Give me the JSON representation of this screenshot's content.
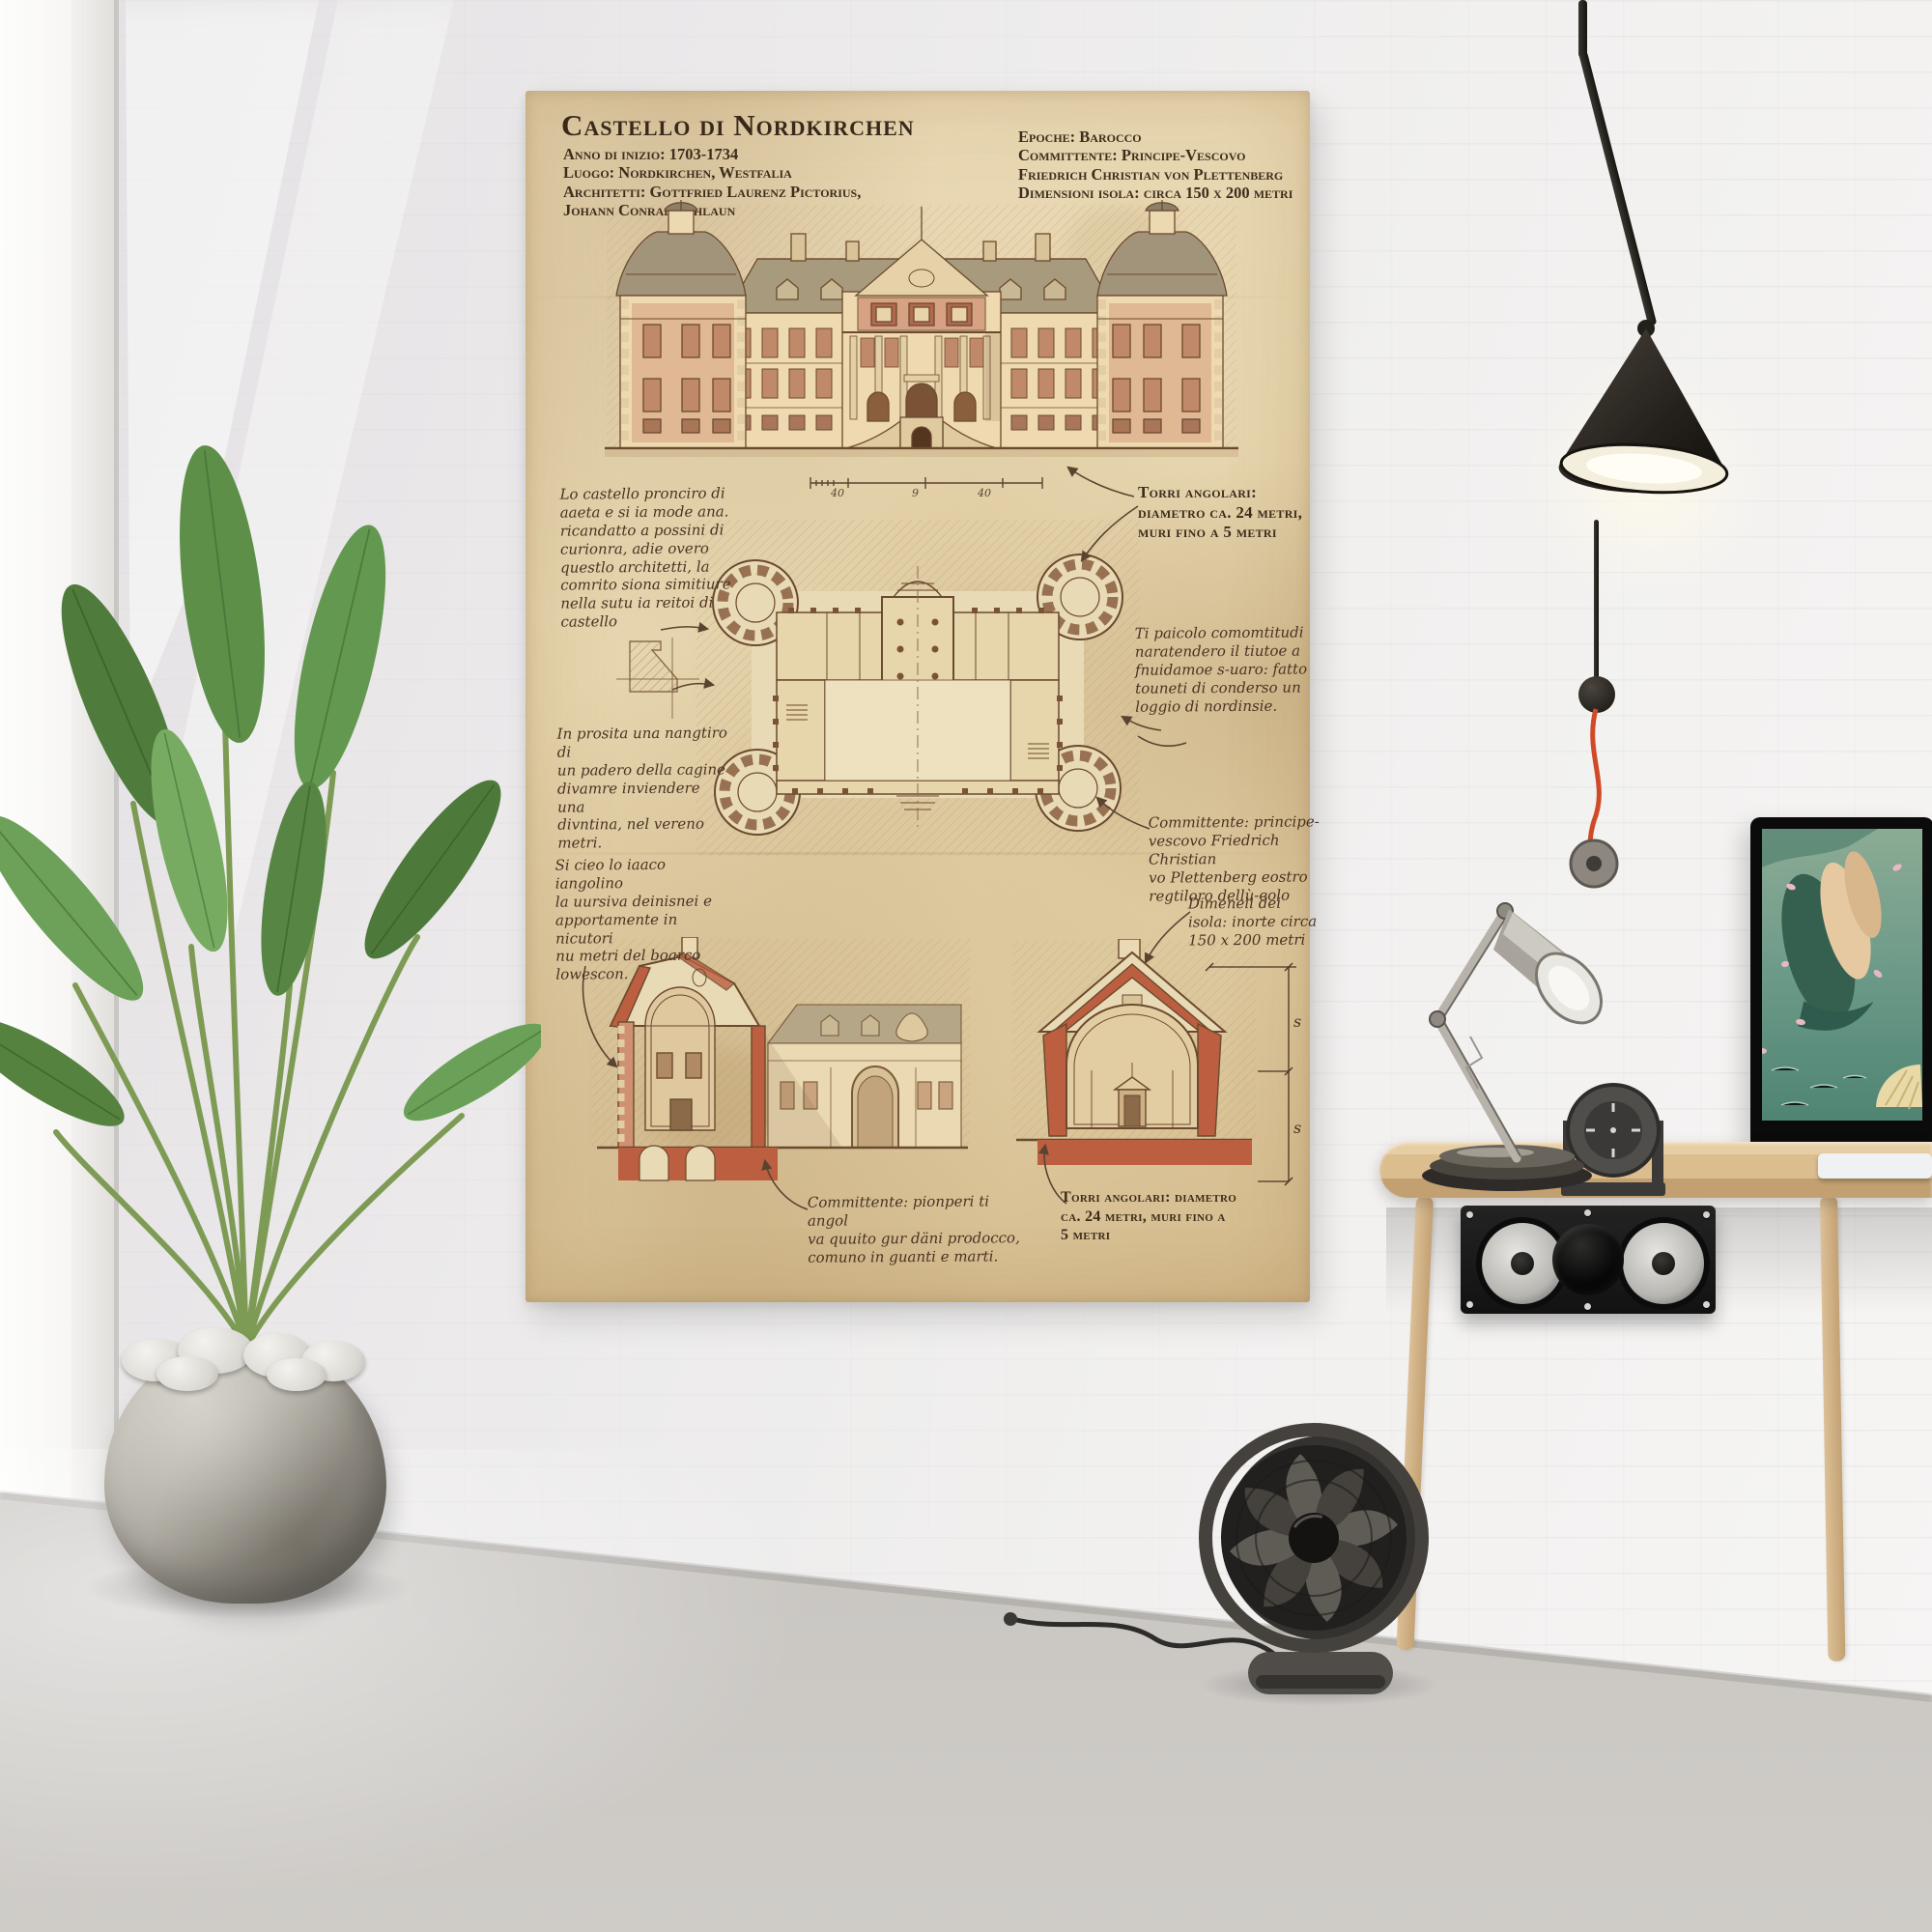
{
  "scene": {
    "colors": {
      "paper": "#e6d5ae",
      "sepia_ink": "#6b4a2e",
      "red_wash": "#bb5f40",
      "wall": "#efedee",
      "floor": "#d3d0cc",
      "accent_cord": "#d14a28"
    }
  },
  "poster": {
    "title": "Castello di Nordkirchen",
    "meta_left": "Anno di inizio: 1703-1734\nLuogo: Nordkirchen, Westfalia\nArchitetti: Gottfried Laurenz Pictorius,\nJohann Conrad Schlaun",
    "meta_right": "Epoche: Barocco\nCommittente: Principe-Vescovo\nFriedrich Christian von Plettenberg\nDimensioni isola: circa 150 x 200 metri",
    "notes": {
      "left_top": "Lo castello pronciro di\naaeta e si ia mode ana.\nricandatto a possini di\ncurionra, adie overo\nquestlo architetti, la\ncomrito siona simitiure\nnella sutu ia reitoi di\ncastello",
      "left_mid": "In prosita una nangtiro di\nun padero della cagine\ndivamre inviendere una\ndivntina, nel vereno\nmetri.",
      "left_bottom": "Si cieo lo iaaco iangolino\nla uursiva deinisnei e\napportamente in nicutori\nnu metri del boarco\nlowescon.",
      "right_top": "Torri angolari:\ndiametro ca. 24 metri,\nmuri fino a 5 metri",
      "right_mid": "Ti paicolo comomtitudi\nnaratendero il tiutoe a\nfnuidamoe s-uaro: fatto\ntouneti di conderso un\nloggio di nordinsie.",
      "right_committente": "Committente: principe-\nvescovo Friedrich Christian\nvo Plettenberg eostro\nregtiloro dellù-eolo",
      "right_dimensioni": "Dimeneii dei\nisola: inorte circa\n150 x 200 metri",
      "bottom_center": "Committente: pionperi ti angol\nva quuito gur däni prodocco,\ncomuno in guanti e marti.",
      "bottom_right": "Torri angolari: diametro\nca. 24 metri, muri fino a\n5 metri"
    },
    "scale_labels": [
      "40",
      "9",
      "40"
    ],
    "dim_labels": [
      "s",
      "s"
    ]
  }
}
